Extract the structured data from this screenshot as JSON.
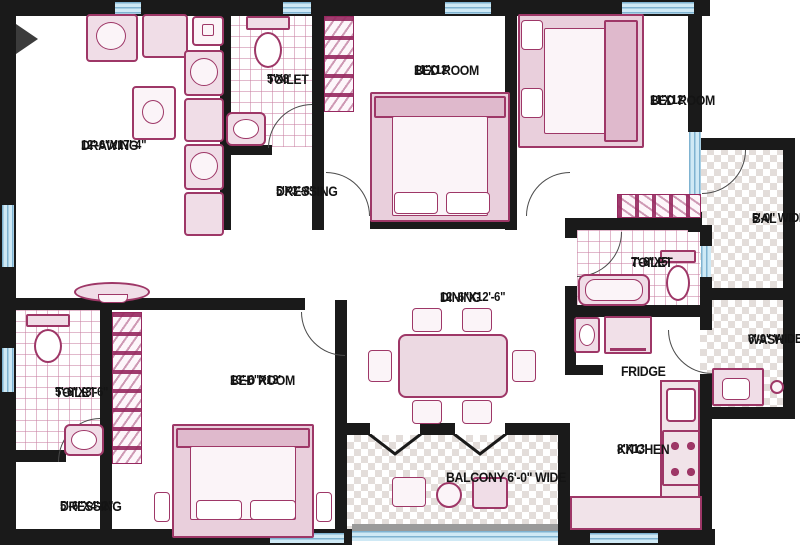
{
  "plan": {
    "rooms": {
      "drawing": {
        "name": "DRAWING",
        "dims": "12'-6\"X17'-4\""
      },
      "toilet_top": {
        "name": "TOILET",
        "dims": "5'X8'"
      },
      "dressing_top": {
        "name": "DRESSING",
        "dims": "5'X3'-8\""
      },
      "bedroom_top": {
        "name": "BED ROOM",
        "dims": "11'X12'"
      },
      "bedroom_right": {
        "name": "BED ROOM",
        "dims": "11'X12'"
      },
      "bal": {
        "name": "BAL",
        "dims": "5'-0\" WIDE"
      },
      "toilet_right": {
        "name": "TOILET",
        "dims": "7'-6\"X5'"
      },
      "wash": {
        "name": "WASH",
        "dims": "6'-9\" WIDE"
      },
      "dining": {
        "name": "DINING",
        "dims": "12'-6\"X12'-6\""
      },
      "fridge": {
        "name": "FRIDGE"
      },
      "toilet_left": {
        "name": "TOILET",
        "dims": "5'-6\"X8'-6\""
      },
      "bedroom_bottom": {
        "name": "BED ROOM",
        "dims": "13'-6\"X13'"
      },
      "dressing_bottom": {
        "name": "DRESSING",
        "dims": "5'-6\"X4'-2\""
      },
      "balcony_bottom": {
        "name": "BALCONY 6'-0\" WIDE"
      },
      "kitchen": {
        "name": "KITCHEN",
        "dims": "8'X13'"
      }
    },
    "colors": {
      "wall": "#1a1a1a",
      "fixture_stroke": "#9e3767",
      "fixture_fill": "#f0dde7",
      "window": "#cfe9f5",
      "tile_line": "#c980a3",
      "checker": "#e3ddda"
    }
  }
}
